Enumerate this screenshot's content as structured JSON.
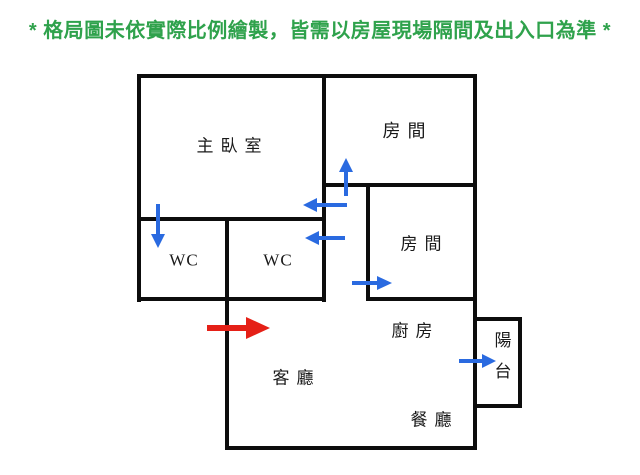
{
  "disclaimer": {
    "text": "* 格局圖未依實際比例繪製，皆需以房屋現場隔間及出入口為準 *"
  },
  "floor_plan": {
    "rooms": {
      "master_bedroom": "主臥室",
      "bedroom_top": "房間",
      "bedroom_middle": "房間",
      "wc_master": "WC",
      "wc_shared": "WC",
      "kitchen": "廚房",
      "living_room": "客廳",
      "dining_room": "餐廳",
      "balcony": "陽台"
    },
    "arrows": {
      "master_wc_door": {
        "direction": "down",
        "color": "blue"
      },
      "master_bedroom_door": {
        "direction": "left",
        "color": "blue"
      },
      "bedroom_top_door": {
        "direction": "up",
        "color": "blue"
      },
      "wc_shared_door": {
        "direction": "left",
        "color": "blue"
      },
      "bedroom_middle_door": {
        "direction": "right",
        "color": "blue"
      },
      "balcony_door": {
        "direction": "right",
        "color": "blue"
      },
      "main_entrance": {
        "direction": "right",
        "color": "red"
      }
    }
  },
  "colors": {
    "disclaimer_green": "#2fa24c",
    "door_arrow_blue": "#2a6ae0",
    "entrance_arrow_red": "#e52017",
    "wall_black": "#0d0d0d",
    "label_text": "#1a1a1a",
    "background": "#ffffff"
  }
}
